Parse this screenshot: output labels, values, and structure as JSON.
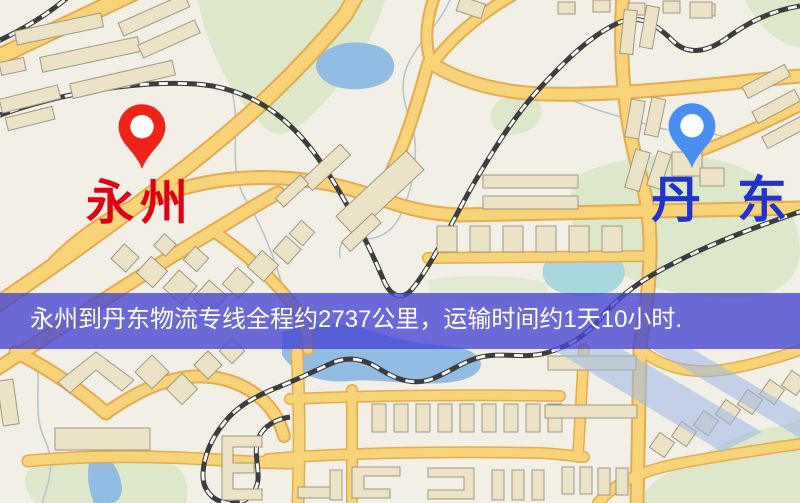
{
  "banner": {
    "text": "永州到丹东物流专线全程约2737公里，运输时间约1天10小时.",
    "bg_color": "#4747d2",
    "text_color": "#ffffff"
  },
  "markers": {
    "origin": {
      "label": "永州",
      "pin_color": "#ef2318",
      "label_color": "#e00013"
    },
    "destination": {
      "label": "丹东",
      "pin_color": "#4a8ef2",
      "label_color": "#2233cc"
    }
  },
  "map_palette": {
    "land": "#f2efe6",
    "park": "#dde8ca",
    "water": "#92bce2",
    "road_fill": "#f8d378",
    "road_casing": "#e3ab52",
    "railway": "#3d3d3d",
    "building": "#ece2c6",
    "building_outline": "#a09781"
  }
}
